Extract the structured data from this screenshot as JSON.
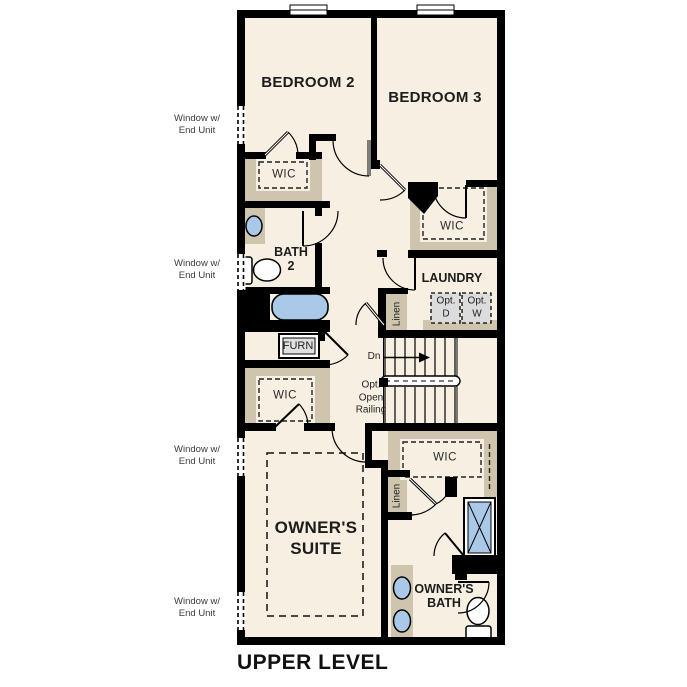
{
  "plan_title": "UPPER LEVEL",
  "colors": {
    "floor": "#f7efe1",
    "wall": "#000000",
    "closet_tan": "#cfc4ae",
    "fixture_blue": "#aac9e8",
    "appliance_gray": "#dcdcdc"
  },
  "labels": {
    "bedroom2": "BEDROOM 2",
    "bedroom3": "BEDROOM 3",
    "wic": "WIC",
    "bath2_line1": "BATH",
    "bath2_line2": "2",
    "laundry": "LAUNDRY",
    "opt_d_line1": "Opt.",
    "opt_d_line2": "D",
    "opt_w_line1": "Opt.",
    "opt_w_line2": "W",
    "linen": "Linen",
    "furn": "FURN",
    "down": "Dn",
    "railing_line1": "Opt.",
    "railing_line2": "Open",
    "railing_line3": "Railing",
    "owners_suite_line1": "OWNER'S",
    "owners_suite_line2": "SUITE",
    "owners_bath_line1": "OWNER'S",
    "owners_bath_line2": "BATH",
    "window_note_line1": "Window w/",
    "window_note_line2": "End Unit"
  },
  "fixtures": [
    "bathtub",
    "shower",
    "toilet",
    "sink",
    "stairs-down",
    "furnace",
    "optional-washer",
    "optional-dryer"
  ]
}
